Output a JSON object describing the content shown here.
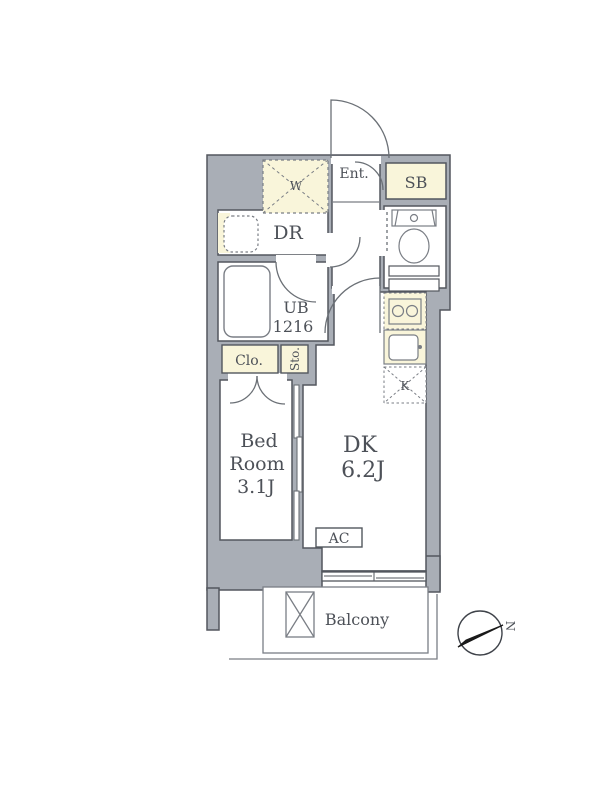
{
  "title": "apartment-floor-plan",
  "labels": {
    "entrance": "Ent.",
    "shoe_box": "SB",
    "dressing_room": "DR",
    "unit_bath_line1": "UB",
    "unit_bath_line2": "1216",
    "closet": "Clo.",
    "storage": "Sto.",
    "washer_space": "W",
    "kitchen_marker": "K",
    "bedroom_line1": "Bed",
    "bedroom_line2": "Room",
    "bedroom_line3": "3.1J",
    "dk_line1": "DK",
    "dk_line2": "6.2J",
    "ac": "AC",
    "balcony": "Balcony",
    "compass_north": "N"
  },
  "colors": {
    "wall_fill": "#a9aeb6",
    "wall_line": "#53575e",
    "fixture_line": "#7a7e85",
    "cream_fill": "#f9f5da",
    "text": "#4d5158",
    "compass_needle": "#1a1a1a"
  }
}
